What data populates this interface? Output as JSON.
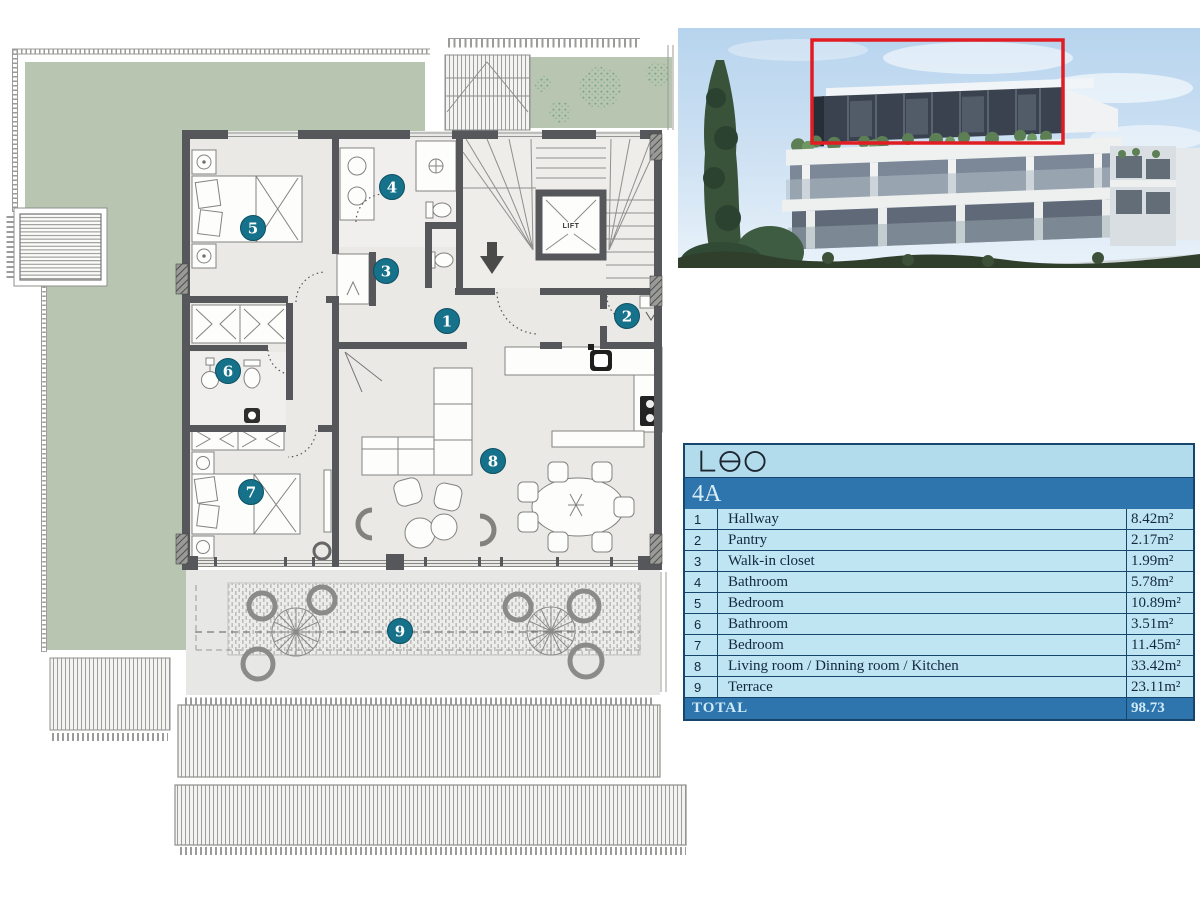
{
  "plan": {
    "lift_label": "LIFT",
    "marker_color": "#16718a",
    "markers": [
      {
        "n": "1",
        "x": 447,
        "y": 321
      },
      {
        "n": "2",
        "x": 627,
        "y": 316
      },
      {
        "n": "3",
        "x": 386,
        "y": 271
      },
      {
        "n": "4",
        "x": 392,
        "y": 187
      },
      {
        "n": "5",
        "x": 253,
        "y": 228
      },
      {
        "n": "6",
        "x": 228,
        "y": 371
      },
      {
        "n": "7",
        "x": 251,
        "y": 492
      },
      {
        "n": "8",
        "x": 493,
        "y": 461
      },
      {
        "n": "9",
        "x": 400,
        "y": 631
      }
    ]
  },
  "photo": {
    "highlight_color": "#e11d23"
  },
  "legend": {
    "logo_text": "Leo",
    "unit": "4A",
    "rows": [
      {
        "num": "1",
        "name": "Hallway",
        "area": "8.42m²"
      },
      {
        "num": "2",
        "name": "Pantry",
        "area": "2.17m²"
      },
      {
        "num": "3",
        "name": "Walk-in closet",
        "area": "1.99m²"
      },
      {
        "num": "4",
        "name": "Bathroom",
        "area": "5.78m²"
      },
      {
        "num": "5",
        "name": "Bedroom",
        "area": "10.89m²"
      },
      {
        "num": "6",
        "name": "Bathroom",
        "area": "3.51m²"
      },
      {
        "num": "7",
        "name": "Bedroom",
        "area": "11.45m²"
      },
      {
        "num": "8",
        "name": "Living room / Dinning room / Kitchen",
        "area": "33.42m²"
      },
      {
        "num": "9",
        "name": "Terrace",
        "area": "23.11m²"
      }
    ],
    "total_label": "TOTAL",
    "total_value": "98.73",
    "colors": {
      "row_light": "#bfe4f2",
      "band_dark": "#2e75ad",
      "border": "#16456e",
      "terrace_green": "#b7c5b1",
      "wall_gray": "#56575b"
    }
  }
}
